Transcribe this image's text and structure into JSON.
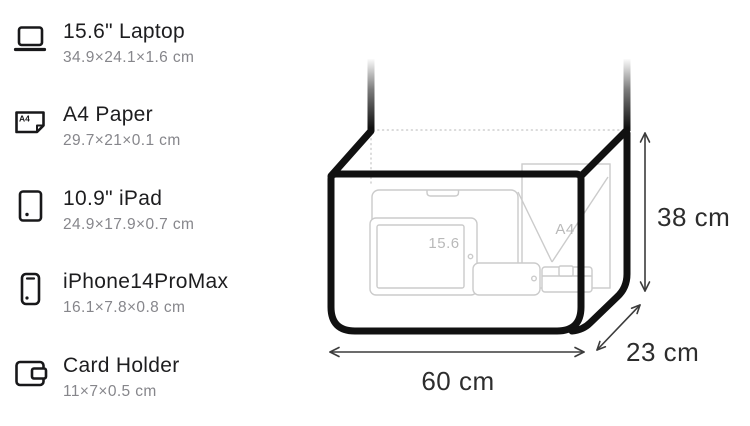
{
  "items": [
    {
      "icon": "laptop-icon",
      "title": "15.6\" Laptop",
      "dimensions": "34.9×24.1×1.6 cm"
    },
    {
      "icon": "a4-paper-icon",
      "title": "A4 Paper",
      "dimensions": "29.7×21×0.1 cm",
      "icon_label": "A4"
    },
    {
      "icon": "ipad-icon",
      "title": "10.9\" iPad",
      "dimensions": "24.9×17.9×0.7 cm"
    },
    {
      "icon": "iphone-icon",
      "title": "iPhone14ProMax",
      "dimensions": "16.1×7.8×0.8 cm"
    },
    {
      "icon": "card-holder-icon",
      "title": "Card Holder",
      "dimensions": "11×7×0.5 cm"
    }
  ],
  "bag": {
    "width_label": "60 cm",
    "height_label": "38 cm",
    "depth_label": "23 cm",
    "laptop_sketch_label": "15.6",
    "paper_sketch_label": "A4"
  },
  "colors": {
    "outline": "#111111",
    "sketch_line": "#cbcbcb",
    "sketch_label": "#b9b9b9",
    "dotted_line": "#cfcfcf",
    "title_text": "#1d1d1f",
    "subtitle_text": "#86868b",
    "dimension_text": "#2d2d2d"
  }
}
